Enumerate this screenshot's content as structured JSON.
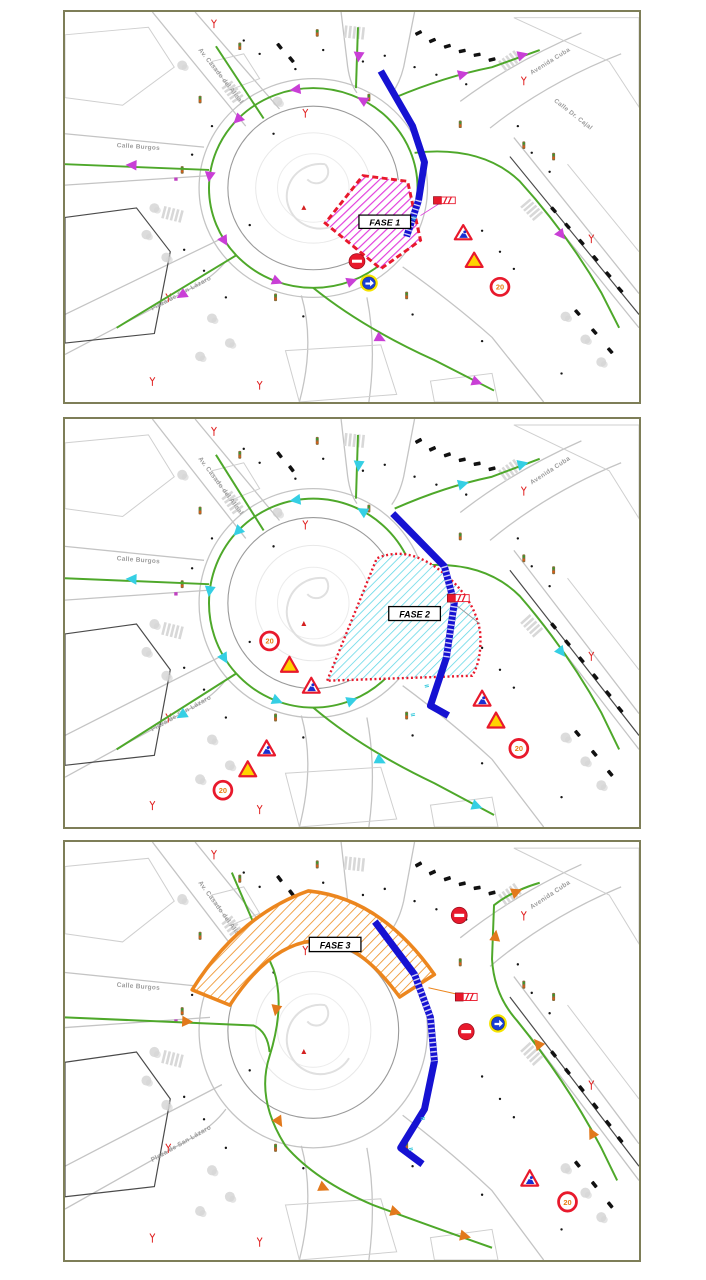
{
  "document": {
    "type": "traffic-phasing-plans",
    "panel_count": 3
  },
  "panels": [
    {
      "name": "FASE 1 plan",
      "phase_label": "FASE 1",
      "arrow_color": "#c93fd6",
      "hatch_color": "#e23ddd",
      "phase_border_color": "#e8192c"
    },
    {
      "name": "FASE 2 plan",
      "phase_label": "FASE 2",
      "arrow_color": "#35cfe4",
      "hatch_color": "#5cd6e6",
      "phase_border_color": "#e8192c"
    },
    {
      "name": "FASE 3 plan",
      "phase_label": "FASE 3",
      "arrow_color": "#e2791c",
      "hatch_color": "#f09c3c",
      "phase_border_color": "#ec861e"
    }
  ],
  "streets": {
    "burgos": "Calle Burgos",
    "alisal": "Av. Casado del Alisal",
    "cuba": "Avenida Cuba",
    "cajal": "Calle Dr. Cajal",
    "lazaro": "Plaza de San Lázaro"
  },
  "signs": {
    "speed_limit": "20",
    "lane_mark": "II",
    "dimension_mark": "31"
  },
  "colors": {
    "detour_route": "#1612d2",
    "traffic_route": "#4ea82a",
    "frame": "#7e7e58"
  }
}
